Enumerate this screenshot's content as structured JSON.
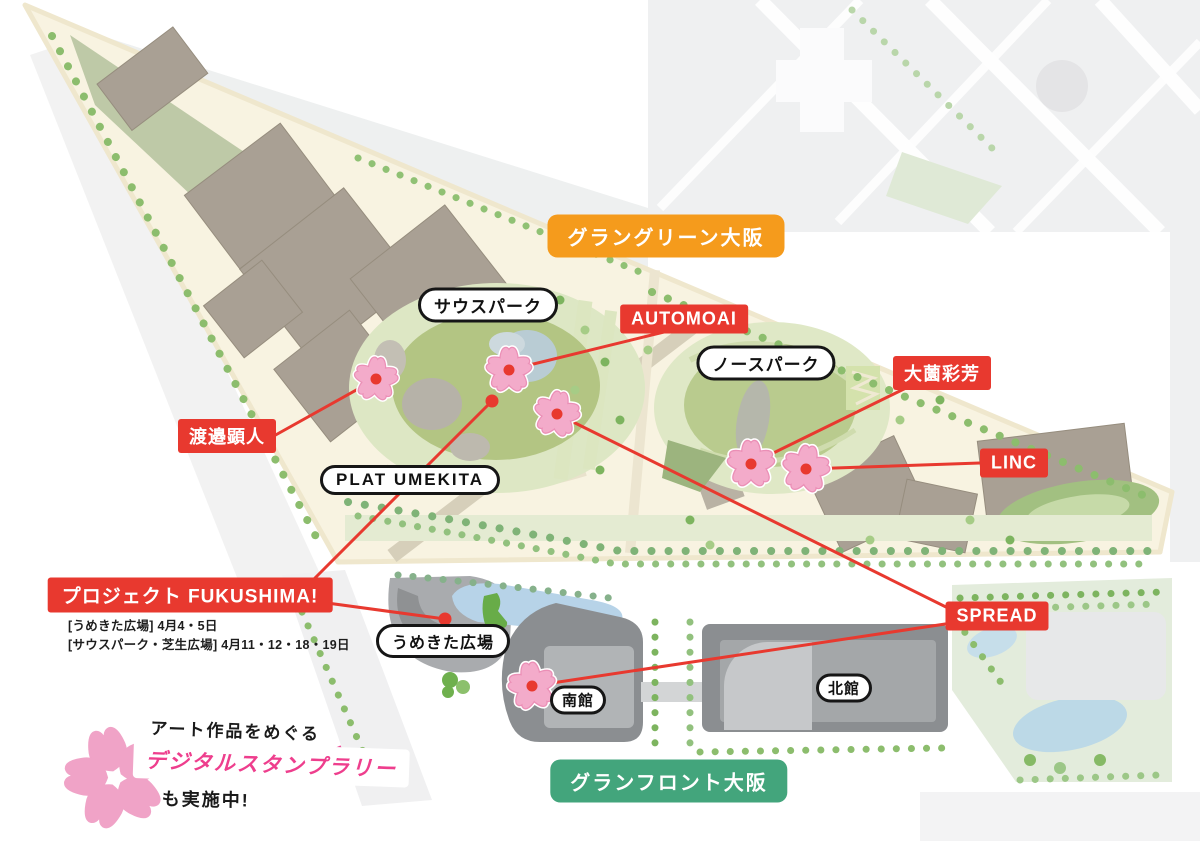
{
  "region_badges": {
    "grand_green": "グラングリーン大阪",
    "grand_front": "グランフロント大阪"
  },
  "places": {
    "south_park": "サウスパーク",
    "north_park": "ノースパーク",
    "plat_umekita": "PLAT UMEKITA",
    "umekita_plaza": "うめきた広場",
    "south_building": "南館",
    "north_building": "北館"
  },
  "artworks": {
    "watanabe": "渡邉顕人",
    "automoai": "AUTOMOAI",
    "osono": "大薗彩芳",
    "linc": "LINC",
    "fukushima": "プロジェクト FUKUSHIMA!",
    "spread": "SPREAD"
  },
  "fukushima_schedule": {
    "line1": "[うめきた広場] 4月4・5日",
    "line2": "[サウスパーク・芝生広場] 4月11・12・18・19日"
  },
  "promo": {
    "line1": "アート作品をめぐる",
    "line2": "デジタルスタンプラリー",
    "line3": "も実施中!"
  },
  "colors": {
    "accent_red": "#e8392f",
    "badge_orange": "#f59b1c",
    "badge_green": "#43a57c",
    "pill_border": "#161616",
    "sakura_pink": "#f3abca",
    "sakura_edge": "#eb8fb6",
    "promo_pink": "#ee3e8d",
    "park_beige": "#f8f3e1",
    "lawn_green": "#b3c583"
  }
}
